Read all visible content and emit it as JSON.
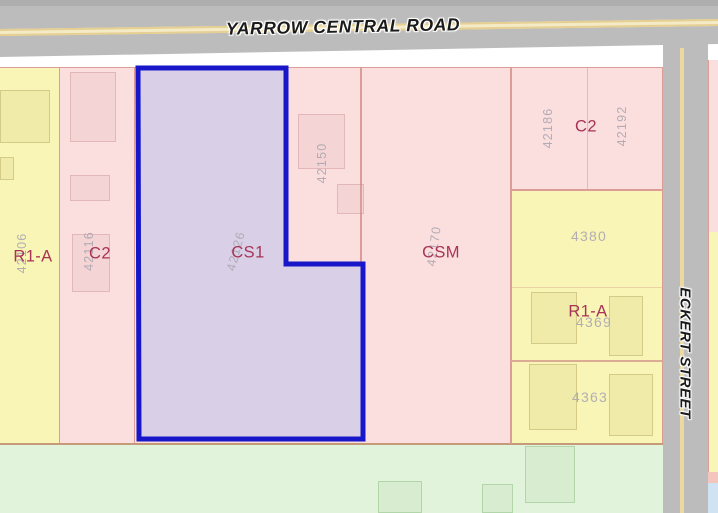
{
  "map": {
    "title": "Zoning parcel map",
    "roads": {
      "yarrow": {
        "label": "YARROW CENTRAL ROAD"
      },
      "eckert": {
        "label": "ECKERT STREET"
      }
    },
    "parcels": {
      "r1a_left": {
        "zone": "R1-A",
        "number": "42106"
      },
      "c2_left": {
        "zone": "C2",
        "number": "42116"
      },
      "cs1": {
        "zone": "CS1",
        "number": "42126",
        "highlighted": true
      },
      "lot_42150": {
        "number": "42150"
      },
      "csm": {
        "zone": "CSM",
        "number": "42170"
      },
      "c2_right": {
        "zone": "C2",
        "number_left": "42186",
        "number_right": "42192"
      },
      "r1a_right": {
        "zone": "R1-A",
        "lot_top": "4380",
        "lot_mid": "4369",
        "lot_bottom": "4363"
      }
    },
    "colors": {
      "highlight_outline": "#1717c9",
      "highlight_fill": "#d9d0e7",
      "commercial_fill": "#fbdede",
      "residential_fill": "#f8f5b6",
      "green_fill": "#e1f3da",
      "road_fill": "#bcbcbc",
      "road_centerline": "#ecd9a0",
      "zone_label": "#a83355",
      "lot_number": "#aea8b2"
    }
  }
}
